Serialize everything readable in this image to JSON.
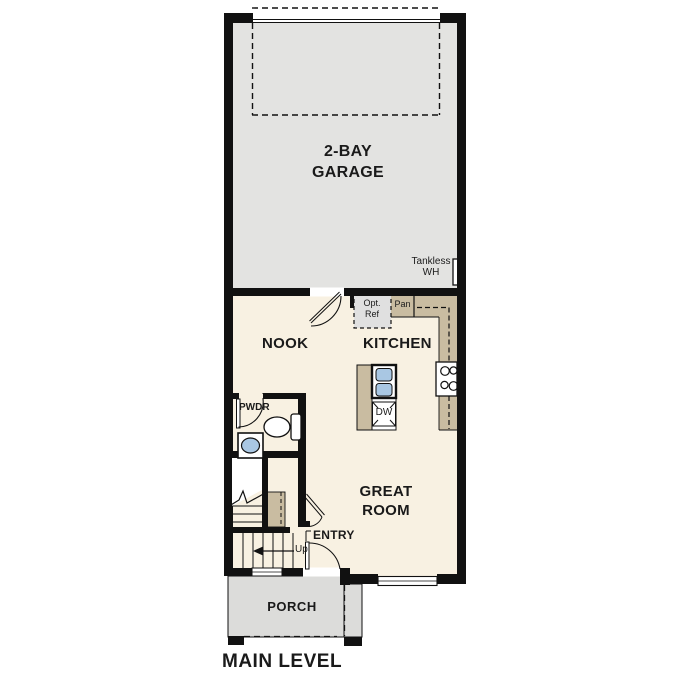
{
  "title": {
    "main_level": "MAIN LEVEL"
  },
  "rooms": {
    "garage": "2-BAY GARAGE",
    "nook": "NOOK",
    "kitchen": "KITCHEN",
    "great_room": "GREAT ROOM",
    "powder": "PWDR",
    "entry": "ENTRY",
    "porch": "PORCH"
  },
  "labels": {
    "tankless_wh": "Tankless WH",
    "opt_ref": "Opt. Ref",
    "pantry": "Pan",
    "dishwasher": "DW",
    "stairs_up": "Up"
  },
  "colors": {
    "wall": "#111111",
    "garage_floor": "#e3e3e1",
    "interior_floor": "#f8f1e2",
    "counter_tan": "#c9bca1",
    "porch_gray": "#dcdcda",
    "fixture_blue": "#a9c7e3",
    "opt_ref_gray": "#e0e0e0",
    "background": "#ffffff"
  }
}
